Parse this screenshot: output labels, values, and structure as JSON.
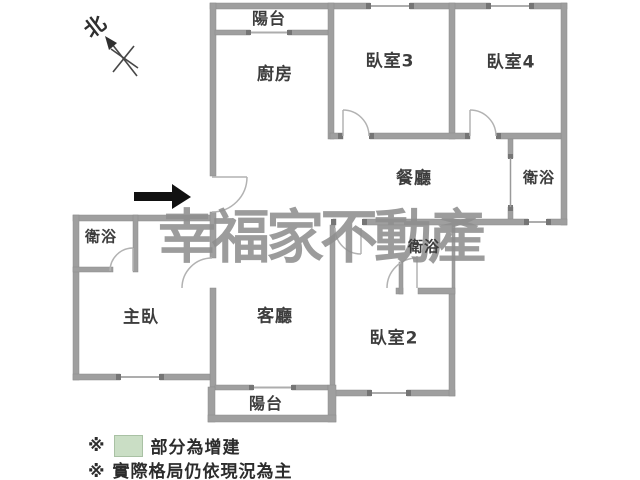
{
  "north_label": "北",
  "watermark": "幸福家不動產",
  "rooms": {
    "balcony_top": "陽台",
    "kitchen": "廚房",
    "bedroom3": "臥室3",
    "bedroom4": "臥室4",
    "dining": "餐廳",
    "bath_right": "衛浴",
    "bath_left": "衛浴",
    "bath_middle": "衛浴",
    "master": "主臥",
    "living": "客廳",
    "bedroom2": "臥室2",
    "balcony_bottom": "陽台"
  },
  "legend": {
    "marker1": "※",
    "line1_text": "部分為增建",
    "line2": "※ 實際格局仍依現況為主",
    "swatch_color": "#cadec5"
  },
  "colors": {
    "wall": "#9f9f9f",
    "wall_cap": "#757575",
    "door_arc": "#b5b5b5",
    "entrance_arrow": "#111111",
    "watermark_gray": "#8f8f8f",
    "label_text": "#3d3d3d"
  }
}
